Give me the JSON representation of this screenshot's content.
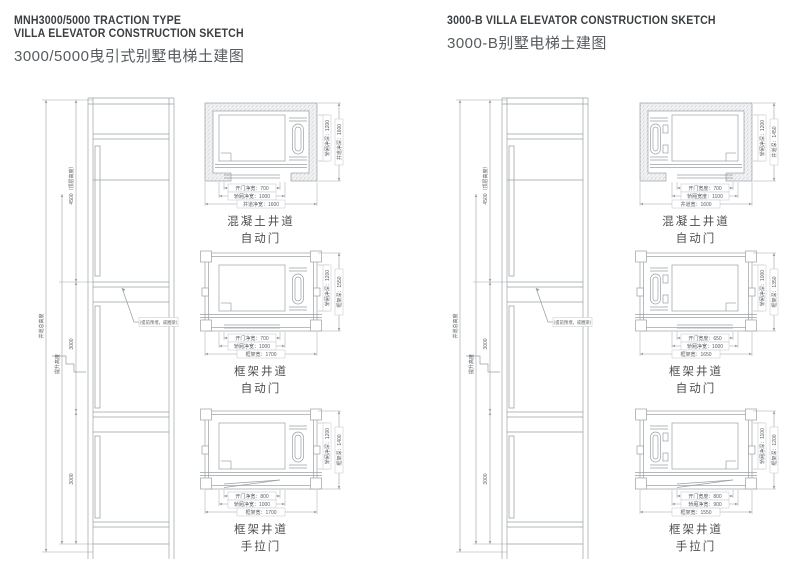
{
  "page": {
    "bg": "#ffffff",
    "line_color": "#9aa0a4",
    "dim_text_color": "#5a5e61",
    "title_color": "#3b3f42"
  },
  "panels": [
    {
      "title_en1": "MNH3000/5000 TRACTION TYPE",
      "title_en2": "VILLA ELEVATOR CONSTRUCTION SKETCH",
      "title_cn": "3000/5000曳引式别墅电梯土建图",
      "elevation": {
        "total_label": "井道总高度",
        "seg_top_label": "4500（顶层高度）",
        "seg_bottom_label": "提升高度",
        "floor_label": "3000",
        "note": "（提前预埋，或圈梁）"
      },
      "plans": [
        {
          "caption1": "混凝土井道",
          "caption2": "自动门",
          "wall": "concrete",
          "door": "auto",
          "cwt": "right",
          "dims_bottom": [
            {
              "label": "开门净宽",
              "value": "700"
            },
            {
              "label": "轿厢净宽",
              "value": "1000"
            },
            {
              "label": "井道净宽",
              "value": "1600"
            }
          ],
          "dims_right": [
            {
              "label": "轿厢净深",
              "value": "1200"
            },
            {
              "label": "井道净深",
              "value": "1600"
            }
          ]
        },
        {
          "caption1": "框架井道",
          "caption2": "自动门",
          "wall": "frame",
          "door": "auto",
          "cwt": "right",
          "dims_bottom": [
            {
              "label": "开门净宽",
              "value": "700"
            },
            {
              "label": "轿厢净宽",
              "value": "1000"
            },
            {
              "label": "框架宽",
              "value": "1700"
            }
          ],
          "dims_right": [
            {
              "label": "轿厢净深",
              "value": "1200"
            },
            {
              "label": "框架深",
              "value": "1550"
            }
          ]
        },
        {
          "caption1": "框架井道",
          "caption2": "手拉门",
          "wall": "frame",
          "door": "manual",
          "cwt": "right",
          "dims_bottom": [
            {
              "label": "开门净宽",
              "value": "800"
            },
            {
              "label": "轿厢净宽",
              "value": "1000"
            },
            {
              "label": "框架宽",
              "value": "1700"
            }
          ],
          "dims_right": [
            {
              "label": "轿厢净深",
              "value": "1200"
            },
            {
              "label": "框架深",
              "value": "1400"
            }
          ]
        }
      ]
    },
    {
      "title_en1": "3000-B VILLA ELEVATOR CONSTRUCTION SKETCH",
      "title_cn": "3000-B别墅电梯土建图",
      "elevation": {
        "total_label": "井道总高度",
        "seg_top_label": "4500（顶层高度）",
        "seg_bottom_label": "提升高度",
        "floor_label": "3000",
        "note": "（提前预埋，或圈梁）"
      },
      "plans": [
        {
          "caption1": "混凝土井道",
          "caption2": "自动门",
          "wall": "concrete",
          "door": "auto",
          "cwt": "left",
          "dims_bottom": [
            {
              "label": "开门宽度",
              "value": "700"
            },
            {
              "label": "轿厢宽度",
              "value": "1100"
            },
            {
              "label": "井道宽",
              "value": "1600"
            }
          ],
          "dims_right": [
            {
              "label": "轿厢净深",
              "value": "1200"
            },
            {
              "label": "井道深",
              "value": "1450"
            }
          ]
        },
        {
          "caption1": "框架井道",
          "caption2": "自动门",
          "wall": "frame",
          "door": "auto",
          "cwt": "left",
          "dims_bottom": [
            {
              "label": "开门宽度",
              "value": "650"
            },
            {
              "label": "轿厢净宽",
              "value": "1000"
            },
            {
              "label": "框架宽",
              "value": "1650"
            }
          ],
          "dims_right": [
            {
              "label": "轿厢净深",
              "value": "1000"
            },
            {
              "label": "框架深",
              "value": "1350"
            }
          ]
        },
        {
          "caption1": "框架井道",
          "caption2": "手拉门",
          "wall": "frame",
          "door": "manual",
          "cwt": "left",
          "dims_bottom": [
            {
              "label": "开门宽度",
              "value": "800"
            },
            {
              "label": "轿厢净宽",
              "value": "900"
            },
            {
              "label": "框架宽",
              "value": "1550"
            }
          ],
          "dims_right": [
            {
              "label": "轿厢净深",
              "value": "1100"
            },
            {
              "label": "框架深",
              "value": "1200"
            }
          ]
        }
      ]
    }
  ]
}
